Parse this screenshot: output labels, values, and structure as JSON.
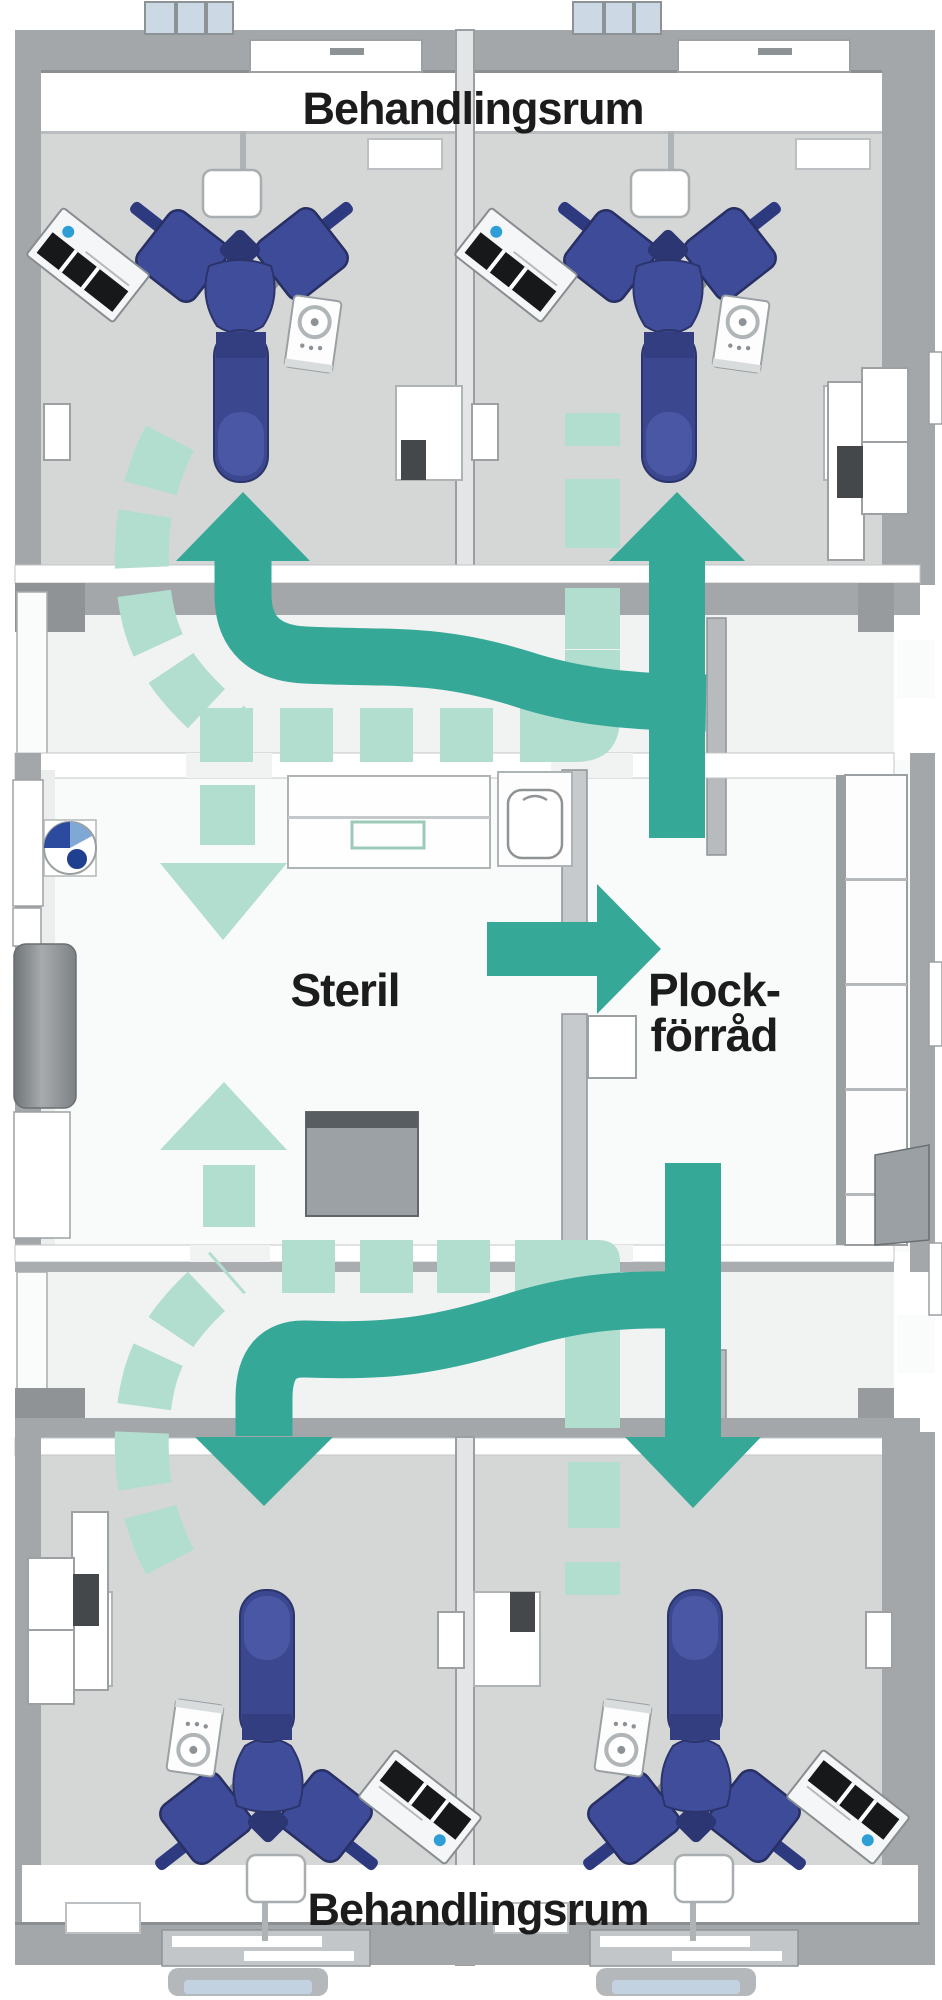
{
  "labels": {
    "top_rooms": "Behandlingsrum",
    "bottom_rooms": "Behandlingsrum",
    "sterile_room": "Steril",
    "storage_room_line1": "Plock-",
    "storage_room_line2": "förråd"
  },
  "colors": {
    "clean-flow": "#36a897",
    "return-flow": "#b2decf",
    "chair-blue": "#3e4a96",
    "chair-dark": "#303a78",
    "floor-gray": "#d5d7d7",
    "corridor-gray": "#f1f2f2",
    "room-white": "#f9fafa",
    "wall-gray": "#a3a7a9",
    "label-text": "#1c1c1c"
  },
  "icons": {
    "clean_flow_arrows": "solid-teal-arrow",
    "return_flow_paths": "dashed-light-teal-arrow"
  }
}
